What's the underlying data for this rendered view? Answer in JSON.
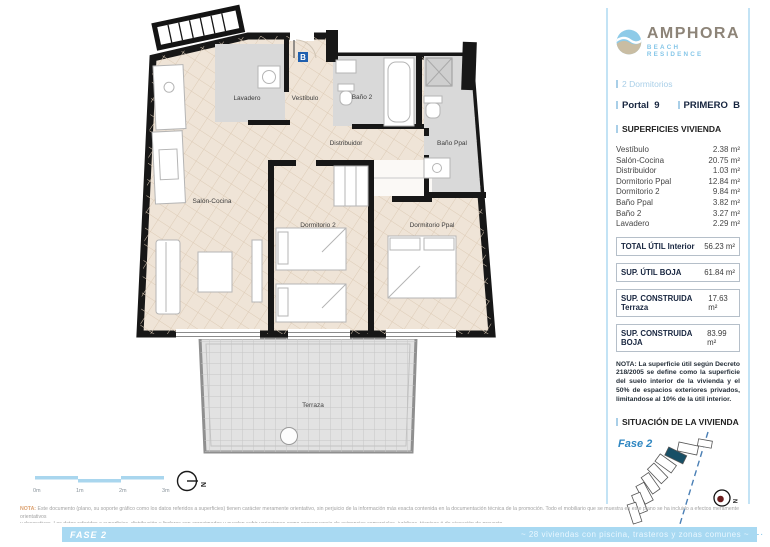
{
  "brand": {
    "name": "AMPHORA",
    "tagline": "BEACH RESIDENCE"
  },
  "panel": {
    "type_label": "2 Dormitorios",
    "portal_label": "Portal",
    "portal_value": "9",
    "floor_label": "PRIMERO",
    "floor_value": "B",
    "surfaces_title": "SUPERFICIES VIVIENDA",
    "rooms": [
      {
        "name": "Vestíbulo",
        "area": "2.38 m²"
      },
      {
        "name": "Salón-Cocina",
        "area": "20.75 m²"
      },
      {
        "name": "Distribuidor",
        "area": "1.03 m²"
      },
      {
        "name": "Dormitorio Ppal",
        "area": "12.84 m²"
      },
      {
        "name": "Dormitorio 2",
        "area": "9.84 m²"
      },
      {
        "name": "Baño Ppal",
        "area": "3.82 m²"
      },
      {
        "name": "Baño 2",
        "area": "3.27 m²"
      },
      {
        "name": "Lavadero",
        "area": "2.29 m²"
      }
    ],
    "totals": [
      {
        "label": "TOTAL ÚTIL Interior",
        "value": "56.23 m²"
      },
      {
        "label": "SUP. ÚTIL BOJA",
        "value": "61.84 m²"
      },
      {
        "label": "SUP. CONSTRUIDA Terraza",
        "value": "17.63 m²"
      },
      {
        "label": "SUP. CONSTRUIDA BOJA",
        "value": "83.99 m²"
      }
    ],
    "nota": "NOTA: La superficie útil según Decreto 218/2005 se define como la superficie del suelo interior de la vivienda y el 50% de espacios exteriores privados, limitandose al 10% de la útil interior.",
    "situacion_title": "SITUACIÓN DE LA VIVIENDA",
    "fase_label": "Fase 2",
    "promueve_label": "PROMUEVE:",
    "promoter": "LIVE REALLY BIG, S.L."
  },
  "plan": {
    "labels": {
      "lavadero": "Lavadero",
      "vestibulo": "Vestíbulo",
      "bano2": "Baño 2",
      "banoppal": "Baño Ppal",
      "distribuidor": "Distribuidor",
      "salon": "Salón-Cocina",
      "dormitorio2": "Dormitorio 2",
      "dormitorioppal": "Dormitorio Ppal",
      "terraza": "Terraza"
    },
    "entrance_marker": "B",
    "scale": [
      "0m",
      "1m",
      "2m",
      "3m"
    ],
    "north": "N"
  },
  "footer": {
    "disclaimer_prefix": "NOTA:",
    "disclaimer_line1": "Este documento (plano, su soporte gráfico como los datos referidos a superficies) tienen carácter meramente orientativo, sin perjuicio de la información más exacta contenida en la documentación técnica de la promoción. Todo el mobiliario que se muestra en este plano se ha incluido a efectos meramente orientativos",
    "disclaimer_line2": "y decorativos. Los datos referidos a superficies, distribución y linderos son aproximados y pueden sufrir variaciones como consecuencia de exigencias comerciales, jurídicas, técnicas ó de ejecución de proyecto.",
    "bar_left": "FASE 2",
    "bar_right": "~ 28 viviendas con piscina, trasteros y zonas comunes ~"
  },
  "colors": {
    "accent": "#a9d6ee",
    "navy": "#17253f",
    "beige": "#efe4d7",
    "gray_room": "#d9d9d9",
    "fase_blue": "#2e86c1",
    "promoter_blue": "#87c7ea",
    "highlight_unit": "#174f66",
    "compass_dot": "#6b1d1d"
  }
}
